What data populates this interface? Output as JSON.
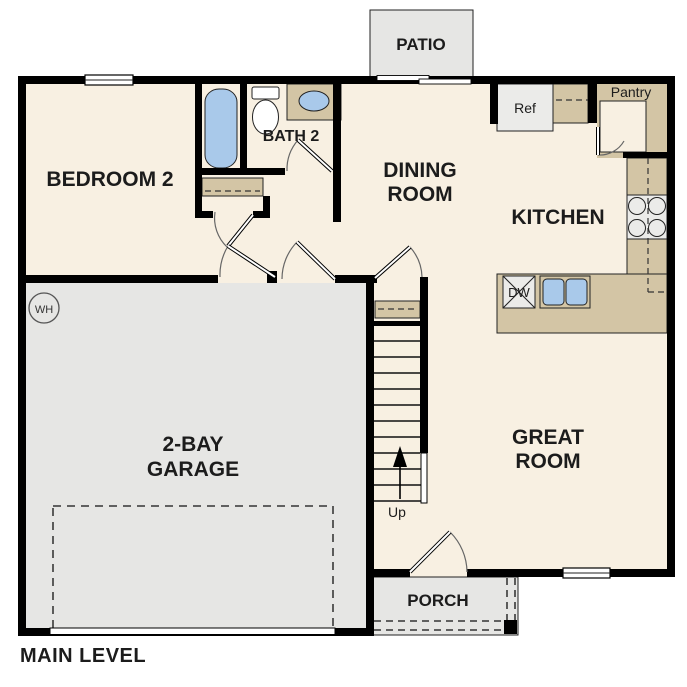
{
  "plan": {
    "title": "MAIN LEVEL",
    "rooms": {
      "bedroom2": {
        "label": "BEDROOM 2"
      },
      "bath2": {
        "label": "BATH 2"
      },
      "dining_room": {
        "line1": "DINING",
        "line2": "ROOM"
      },
      "kitchen": {
        "label": "KITCHEN"
      },
      "great_room": {
        "line1": "GREAT",
        "line2": "ROOM"
      },
      "garage": {
        "line1": "2-BAY",
        "line2": "GARAGE"
      },
      "patio": {
        "label": "PATIO"
      },
      "porch": {
        "label": "PORCH"
      },
      "pantry": {
        "label": "Pantry"
      }
    },
    "fixtures": {
      "refrigerator": {
        "label": "Ref"
      },
      "dishwasher": {
        "label": "DW"
      },
      "water_heater": {
        "label": "WH"
      },
      "stairs": {
        "label": "Up"
      }
    }
  },
  "colors": {
    "wall": "#000000",
    "floor_cream": "#f8f0e2",
    "concrete_gray": "#e6e6e4",
    "appliance_gray": "#ebebe9",
    "counter_tan": "#d3c5a5",
    "fixture_blue": "#a9c9ea",
    "text": "#1c1c1c",
    "background": "#ffffff"
  }
}
